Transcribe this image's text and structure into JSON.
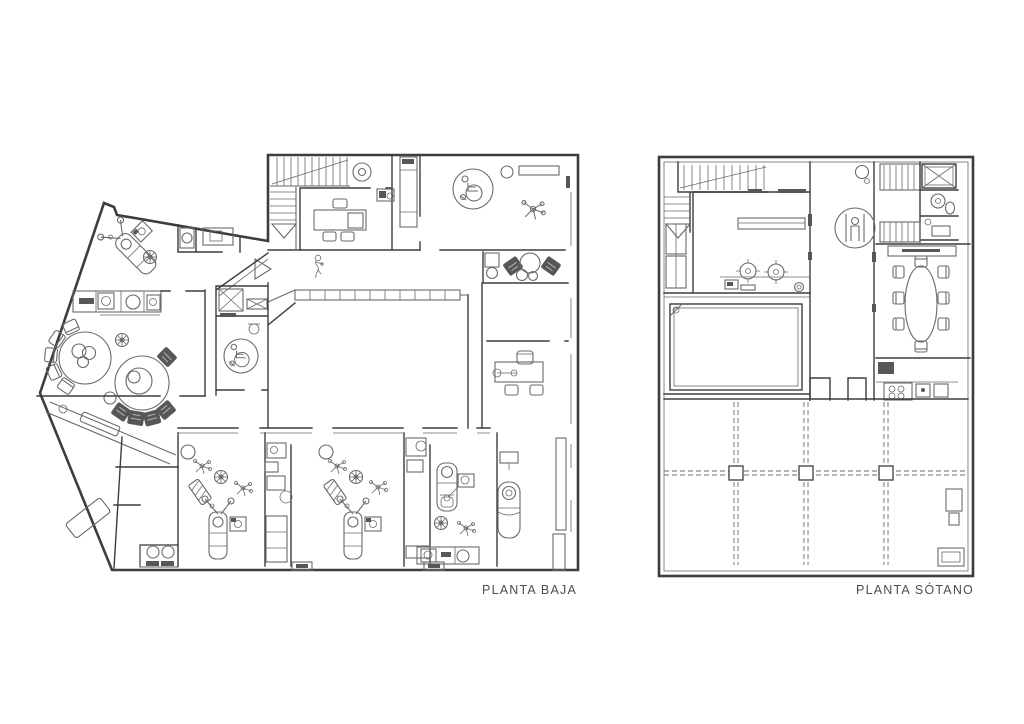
{
  "page": {
    "background": "#ffffff"
  },
  "drawing": {
    "type": "architectural-floor-plan",
    "plans": [
      {
        "id": "planta-baja",
        "label": "PLANTA BAJA"
      },
      {
        "id": "planta-sotano",
        "label": "PLANTA SÓTANO"
      }
    ],
    "symbols": [
      "stairs",
      "elevator-person",
      "wheelchair-accessible",
      "dental-chair",
      "waiting-area-seating",
      "round-table",
      "meeting-table",
      "kitchen-hob",
      "shower",
      "toilet",
      "structural-column-grid",
      "reception-counter"
    ]
  },
  "theme": {
    "bg_color": "#ffffff",
    "wall_color": "#3d3d3d",
    "line_color": "#6a6a6a",
    "dark_fill": "#575757",
    "label_color": "#4d4d4d"
  }
}
